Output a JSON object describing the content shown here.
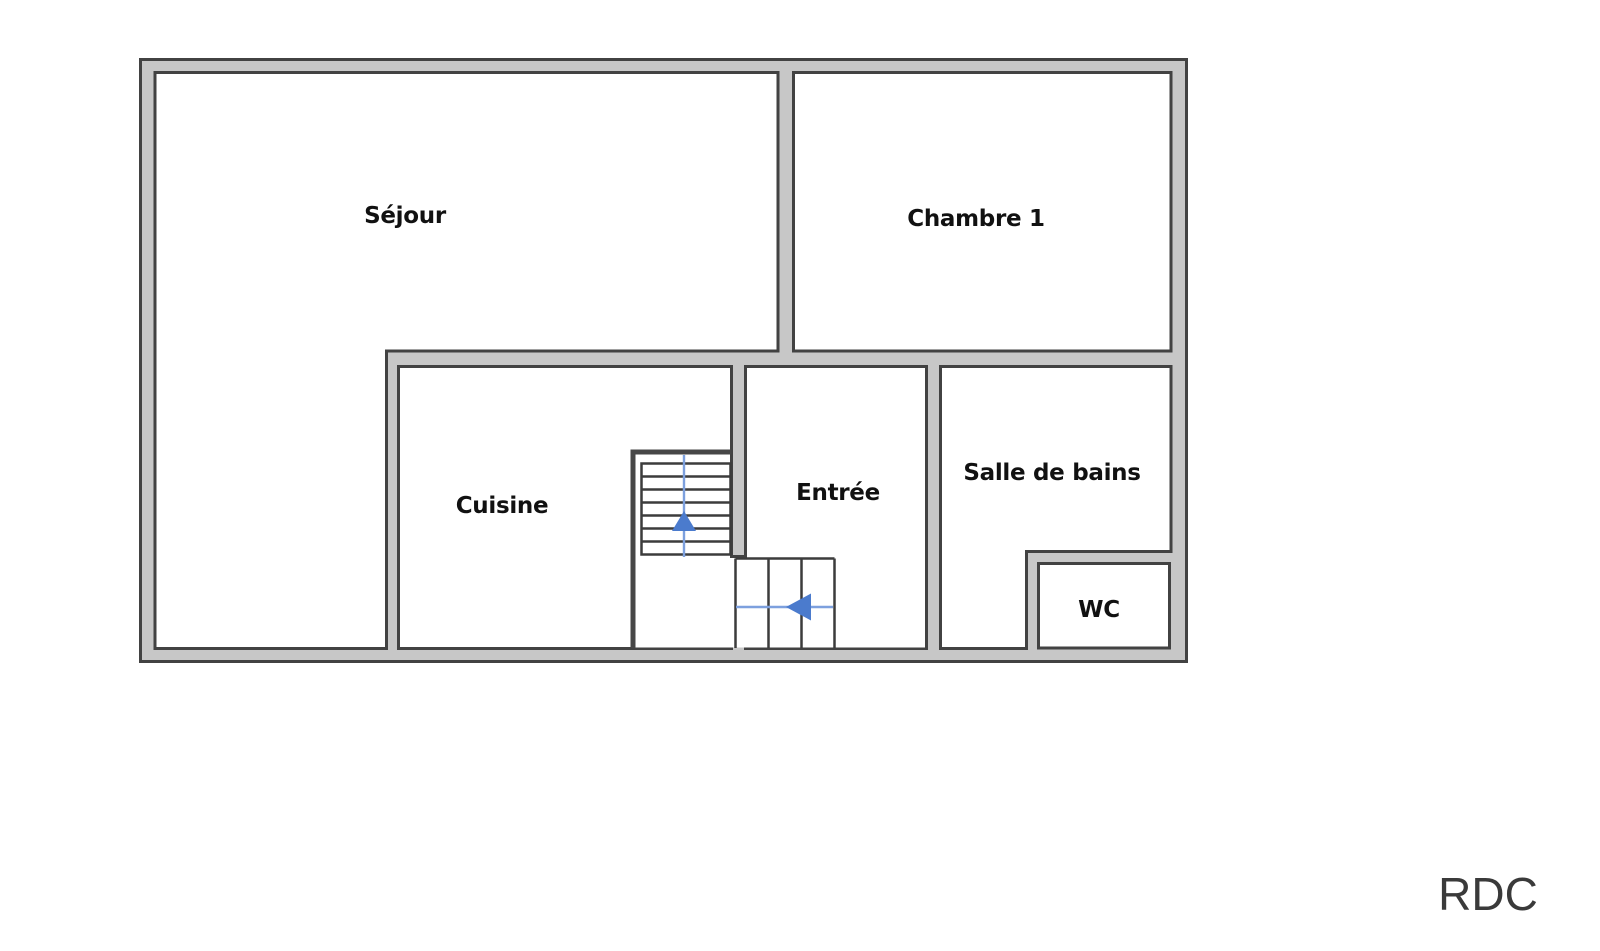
{
  "floor_plan": {
    "floor_label": "RDC",
    "rooms": [
      {
        "name": "sejour",
        "label": "Séjour"
      },
      {
        "name": "chambre-1",
        "label": "Chambre 1"
      },
      {
        "name": "cuisine",
        "label": "Cuisine"
      },
      {
        "name": "entree",
        "label": "Entrée"
      },
      {
        "name": "salle-de-bains",
        "label": "Salle de bains"
      },
      {
        "name": "wc",
        "label": "WC"
      }
    ],
    "stairs": {
      "upper_flight_treads": 7,
      "lower_flight_treads": 3,
      "up_arrow_icon": "arrow-up",
      "left_arrow_icon": "arrow-left"
    },
    "colors": {
      "background": "#ffffff",
      "wall_fill": "#c7c7c7",
      "wall_outline": "#424242",
      "room_fill": "#ffffff",
      "stair_line": "#3c3c3c",
      "arrow_shaft_blue": "#7da0de",
      "arrow_head_blue": "#4b7bcd",
      "room_label_color": "#111111",
      "floor_label_color": "#3a3a3a"
    }
  }
}
